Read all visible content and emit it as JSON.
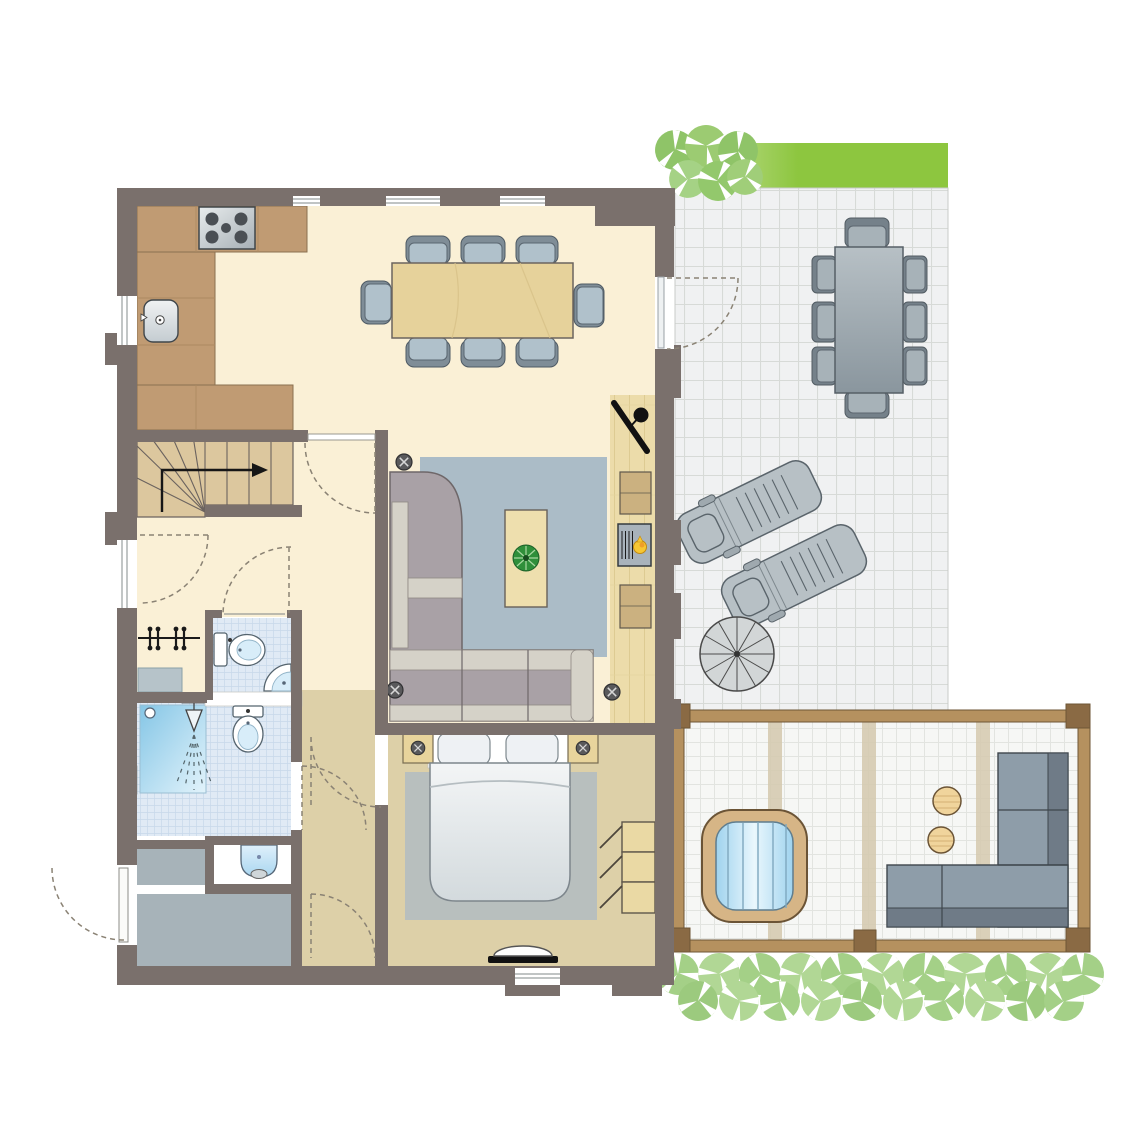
{
  "title": "Floor plan - single-storey holiday home with terrace and wellness veranda",
  "legend_text": "",
  "palette": {
    "wall": "#7a706c",
    "floor_cream": "#faf0d6",
    "floor_tan": "#ddd0a8",
    "floor_gray": "#a7b3b9",
    "bath_tile": "#e0eaf5",
    "bath_grid": "#c7d8ea",
    "counter": "#c09b73",
    "counter_edge": "#8a7050",
    "stairs_wood": "#dcc79e",
    "wood_floor": "#ecdcaa",
    "table_wood": "#e6d29b",
    "rug_living": "#abbcc7",
    "rug_bed": "#b8bfbe",
    "sofa_body": "#a9a1a6",
    "sofa_light": "#d5d2c8",
    "chair_seat": "#b0c1cb",
    "chair_back": "#7f8d97",
    "terrace_tile": "#f0f1f2",
    "terrace_grid": "#d7dad7",
    "hedge_light": "#cfe5ab",
    "hedge_green": "#8dc63f",
    "tree_a": "#8fc468",
    "tree_b": "#9ccb72",
    "tree_c": "#a5d285",
    "bush_a": "#a4d087",
    "bush_b": "#b1d795",
    "outdoor_gray": "#a7b2b8",
    "outdoor_dark": "#75818a",
    "frame_wood": "#b5915f",
    "post_wood": "#8a6a44",
    "sauna_tile": "#f6f7f5",
    "sauna_grid": "#e2e4e0",
    "beam": "#d5c9ae",
    "tub_rim": "#d6b586",
    "water_blue": "#9fd3ee",
    "stool": "#f0d49c",
    "osofa": "#8e9da9",
    "osofa_dark": "#6f7b87",
    "pillow": "#eef1f4",
    "fixture_blue": "#d8edf9",
    "shower_blue": "#85c6e6",
    "plant": "#2f8f3a",
    "flame": "#f7c733",
    "tv": "#111111",
    "arc": "#8a8274",
    "wardrobe": "#ead9a4",
    "cabinet": "#cbb180",
    "white": "#ffffff"
  },
  "rooms": [
    {
      "id": "kitchen-dining",
      "furniture": [
        "u-shaped-counter",
        "cooktop-5-burners",
        "kitchen-sink",
        "dining-table",
        "dining-chairs-x8"
      ]
    },
    {
      "id": "living-room",
      "furniture": [
        "corner-sofa",
        "coffee-table",
        "plant",
        "area-rug",
        "wall-tv",
        "fireplace",
        "cabinets-x2",
        "ceiling-spotlights"
      ]
    },
    {
      "id": "hall",
      "furniture": [
        "staircase-up-with-arrow",
        "coat-rack",
        "door-swings"
      ]
    },
    {
      "id": "wc",
      "furniture": [
        "toilet",
        "corner-washbasin"
      ]
    },
    {
      "id": "bathroom",
      "furniture": [
        "shower",
        "toilet",
        "washbasin"
      ]
    },
    {
      "id": "storage-room",
      "furniture": [
        "entrance-door"
      ]
    },
    {
      "id": "bedroom",
      "furniture": [
        "double-bed",
        "pillows-x2",
        "area-rug",
        "wardrobe-3-sections",
        "reading-spotlights-x2",
        "wall-console"
      ]
    },
    {
      "id": "terrace",
      "furniture": [
        "hedge",
        "trees",
        "outdoor-dining-table",
        "outdoor-chairs-x8",
        "sun-loungers-x2",
        "spiral-staircase"
      ]
    },
    {
      "id": "wellness-veranda",
      "furniture": [
        "timber-frame",
        "hot-tub",
        "side-tables-x2",
        "outdoor-corner-sofa",
        "shrub-row"
      ]
    }
  ]
}
